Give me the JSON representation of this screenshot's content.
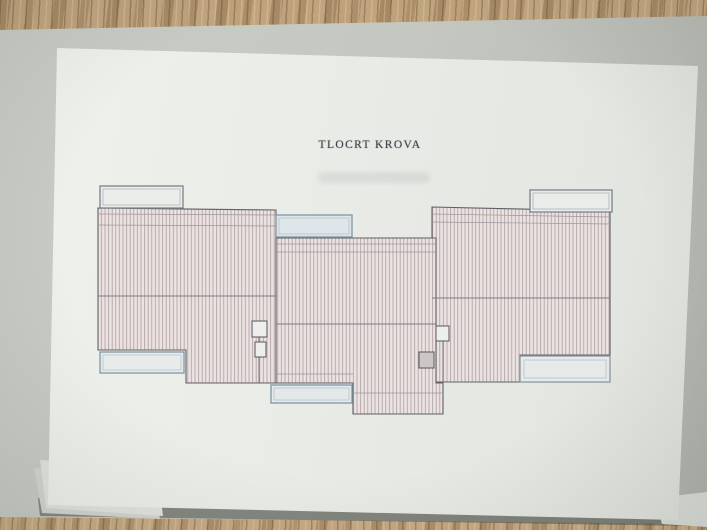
{
  "drawing": {
    "title": "TLOCRT KROVA"
  },
  "colors": {
    "paper": "#e9ebe6",
    "backing_gray": "#c6c9c2",
    "wood": "#bf9f79",
    "outline": "#5b5a62",
    "ridge_line": "#7d7680",
    "eave_line": "#9a929b",
    "hatch_line": "#ab9a9d",
    "hatch_fill": "#ece3e1",
    "blue_detail": "#7b93a6",
    "skylight_fill": "#dfe6ea",
    "chimney_fill": "#c9c6c3"
  },
  "roof_plan": {
    "sections": [
      "left-wing",
      "center-section",
      "right-wing"
    ],
    "openings": [
      "top-left",
      "top-center",
      "top-right",
      "bottom-left",
      "bottom-center",
      "bottom-right"
    ],
    "chimney_count": 4
  }
}
